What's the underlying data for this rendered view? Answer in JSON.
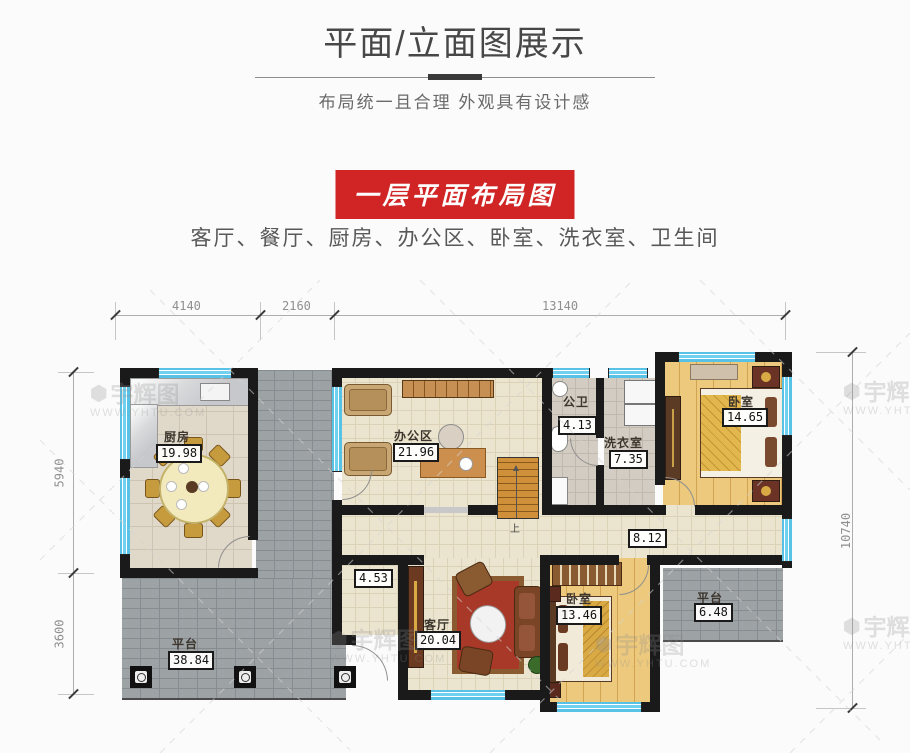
{
  "header": {
    "title": "平面/立面图展示",
    "subtitle": "布局统一且合理 外观具有设计感"
  },
  "banner": {
    "label": "一层平面布局图"
  },
  "room_list": "客厅、餐厅、厨房、办公区、卧室、洗衣室、卫生间",
  "dimensions": {
    "top": [
      "4140",
      "2160",
      "13140"
    ],
    "left": [
      "5940",
      "3600"
    ],
    "right": [
      "10740"
    ]
  },
  "rooms": {
    "kitchen": {
      "name": "厨房",
      "area": "19.98"
    },
    "office": {
      "name": "办公区",
      "area": "21.96"
    },
    "bath": {
      "name": "公卫",
      "area": "4.13"
    },
    "laundry": {
      "name": "洗衣室",
      "area": "7.35"
    },
    "bedroom1": {
      "name": "卧室",
      "area": "14.65"
    },
    "hallway": {
      "area": "8.12"
    },
    "entry": {
      "area": "4.53"
    },
    "living": {
      "name": "客厅",
      "area": "20.04"
    },
    "bedroom2": {
      "name": "卧室",
      "area": "13.46"
    },
    "terrace_right": {
      "name": "平台",
      "area": "6.48"
    },
    "terrace_left": {
      "name": "平台",
      "area": "38.84"
    }
  },
  "stairs": {
    "up_label": "上"
  },
  "watermark": {
    "logo": "宇辉图",
    "hex": "⬢",
    "url": "WWW.YHTU.COM"
  },
  "colors": {
    "banner_red": "#d02425",
    "wall_black": "#1a1a1a",
    "window_blue": "#62c8ea",
    "wood_floor": "#ecc97d",
    "tile_beige": "#ebe4cf",
    "brick_gray": "#9da2a5"
  }
}
